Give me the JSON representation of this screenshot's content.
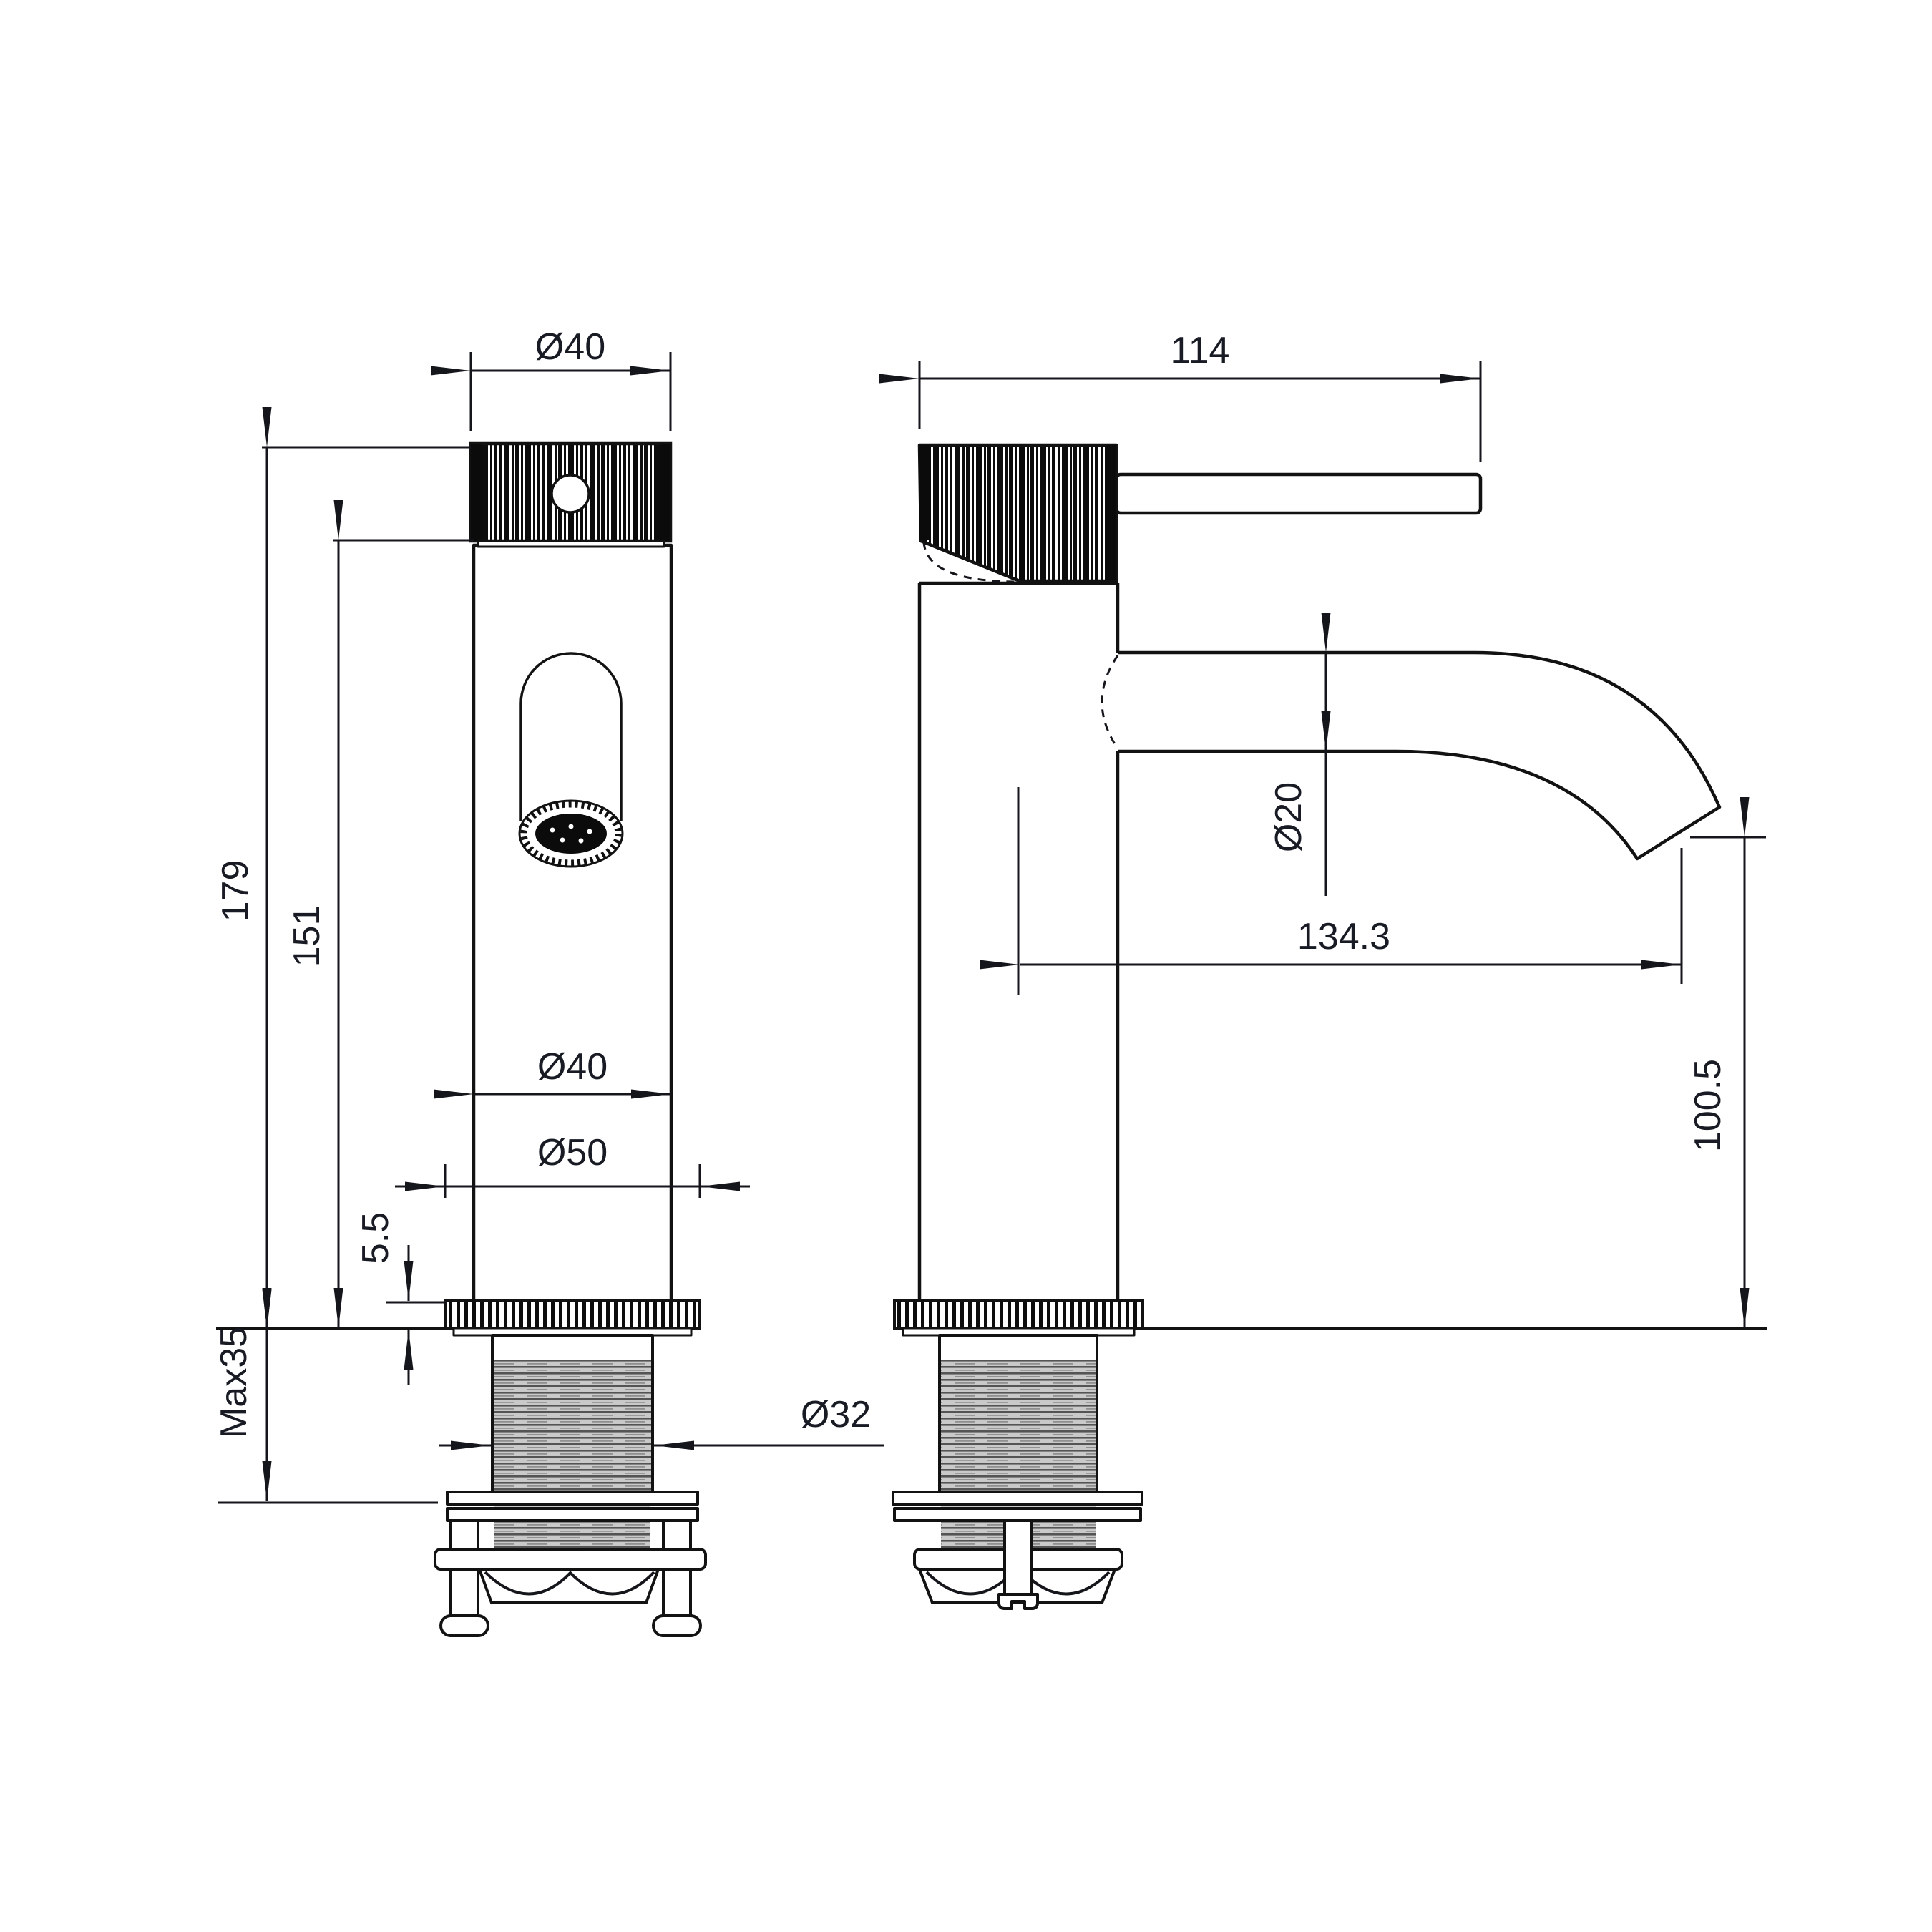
{
  "drawing_type": "faucet-dimension-drawing",
  "colors": {
    "line": "#121212",
    "dimension_text": "#181a24",
    "thread_fill": "#c9c9c9"
  },
  "dimensions": {
    "front_view": {
      "handle_diameter": "Ø40",
      "total_height": "179",
      "body_height": "151",
      "body_diameter": "Ø40",
      "base_diameter": "Ø50",
      "base_ring_height": "5.5",
      "max_mounting_thickness": "Max35",
      "shank_thread_diameter": "Ø32"
    },
    "side_view": {
      "handle_depth": "114",
      "spout_tube_diameter": "Ø20",
      "spout_reach": "134.3",
      "spout_outlet_height": "100.5"
    }
  }
}
